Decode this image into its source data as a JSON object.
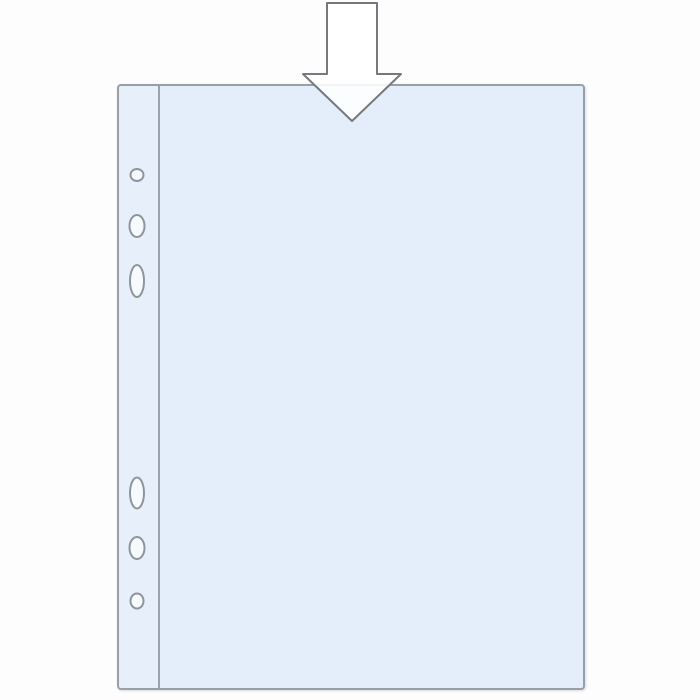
{
  "illustration": {
    "subject": "punched-pocket-sheet-protector",
    "action_hint": "insert-document-from-top",
    "holes_count": 6
  },
  "colors": {
    "background": "#fdfdfd",
    "pocket_fill": "#e3eefa",
    "strip_fill": "#e7f0fa",
    "pocket_border": "#98a0a7",
    "seam_line": "#9aa3ac",
    "hole_fill": "#f6fafd",
    "hole_stroke": "#8e969d",
    "arrow_fill": "rgba(255,255,255,0.88)",
    "arrow_stroke": "#75797d"
  }
}
